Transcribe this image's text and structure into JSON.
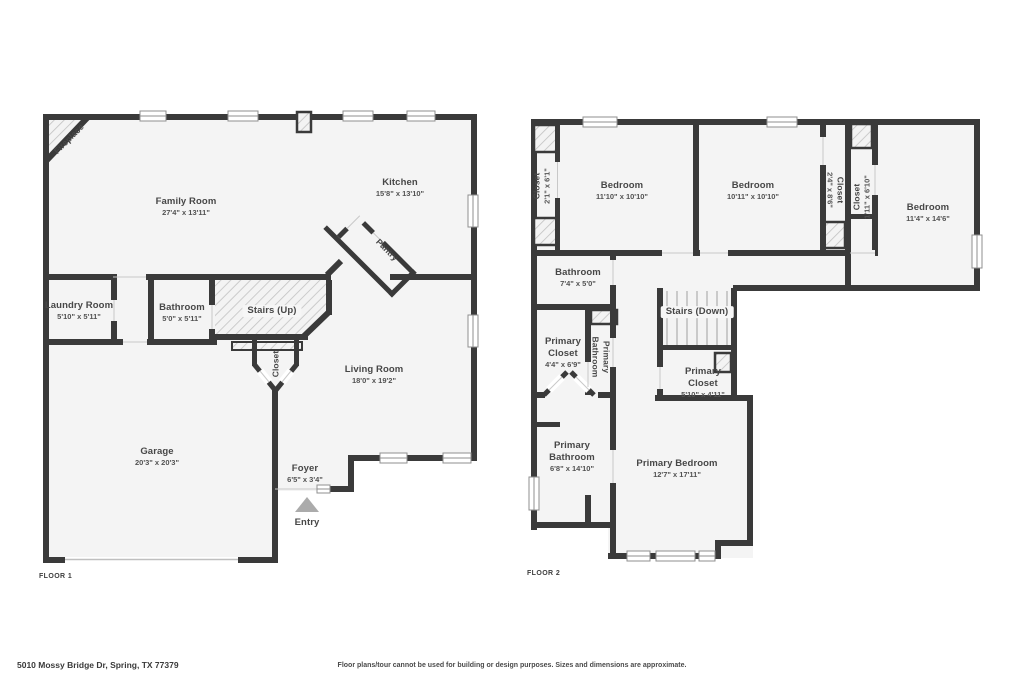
{
  "colors": {
    "wall": "#3a3a3a",
    "room_fill": "#f4f4f4",
    "hatch_line": "#c2c2c2",
    "label_text": "#474747",
    "entry_marker": "#ababab"
  },
  "floor1": {
    "label": "FLOOR 1",
    "rooms": {
      "fireplace": {
        "name": "Fireplace"
      },
      "family_room": {
        "name": "Family Room",
        "dims": "27'4\" x 13'11\""
      },
      "kitchen": {
        "name": "Kitchen",
        "dims": "15'8\" x 13'10\""
      },
      "pantry": {
        "name": "Pantry"
      },
      "laundry_room": {
        "name": "Laundry Room",
        "dims": "5'10\" x 5'11\""
      },
      "bathroom": {
        "name": "Bathroom",
        "dims": "5'0\" x 5'11\""
      },
      "stairs": {
        "name": "Stairs (Up)"
      },
      "closet": {
        "name": "Closet"
      },
      "living_room": {
        "name": "Living Room",
        "dims": "18'0\" x 19'2\""
      },
      "garage": {
        "name": "Garage",
        "dims": "20'3\" x 20'3\""
      },
      "foyer": {
        "name": "Foyer",
        "dims": "6'5\" x 3'4\""
      },
      "entry": {
        "name": "Entry"
      }
    }
  },
  "floor2": {
    "label": "FLOOR 2",
    "rooms": {
      "closet_left": {
        "name": "Closet",
        "dims": "2'1\" x 6'1\""
      },
      "bedroom_1": {
        "name": "Bedroom",
        "dims": "11'10\" x 10'10\""
      },
      "bedroom_2": {
        "name": "Bedroom",
        "dims": "10'11\" x 10'10\""
      },
      "closet_middle": {
        "name": "Closet",
        "dims": "2'4\" x 8'6\""
      },
      "closet_right": {
        "name": "Closet",
        "dims": "1'11\" x 6'10\""
      },
      "bedroom_3": {
        "name": "Bedroom",
        "dims": "11'4\" x 14'6\""
      },
      "bathroom": {
        "name": "Bathroom",
        "dims": "7'4\" x 5'0\""
      },
      "stairs": {
        "name": "Stairs (Down)"
      },
      "primary_closet_1": {
        "name": "Primary Closet",
        "dims": "4'4\" x 6'9\""
      },
      "primary_bathroom_wc": {
        "name": "Primary Bathroom"
      },
      "primary_closet_2": {
        "name": "Primary Closet",
        "dims": "5'10\" x 4'11\""
      },
      "primary_bathroom": {
        "name": "Primary Bathroom",
        "dims": "6'8\" x 14'10\""
      },
      "primary_bedroom": {
        "name": "Primary Bedroom",
        "dims": "12'7\" x 17'11\""
      }
    }
  },
  "footer": {
    "address": "5010 Mossy Bridge Dr, Spring, TX 77379",
    "disclaimer": "Floor plans/tour cannot be used for building or design purposes. Sizes and dimensions are approximate."
  }
}
